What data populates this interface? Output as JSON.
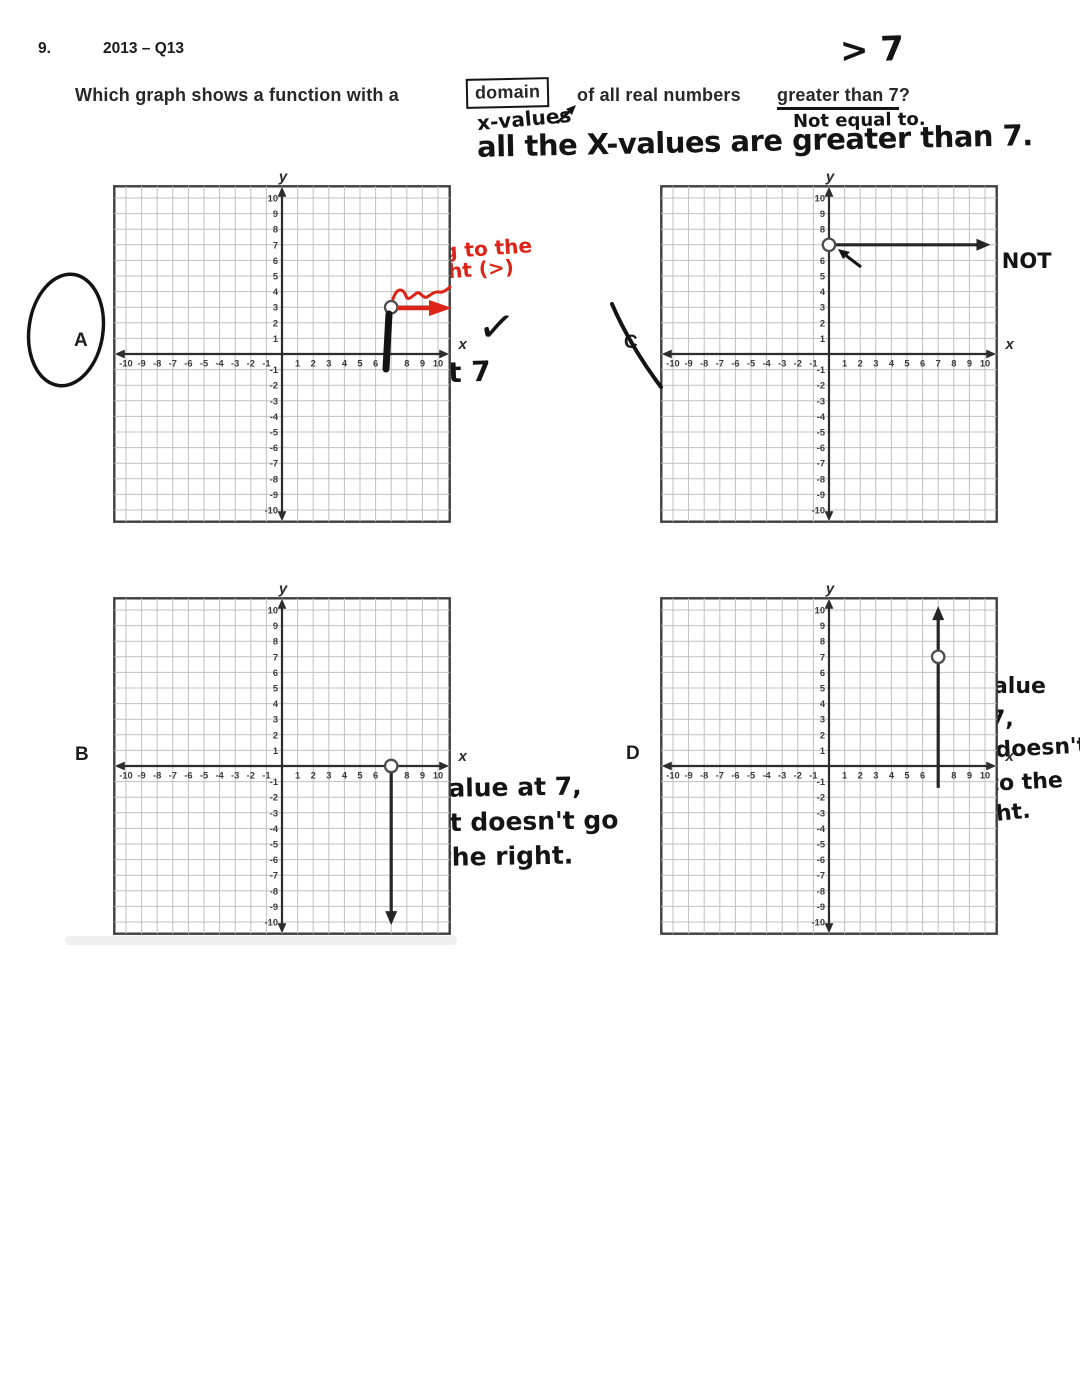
{
  "document": {
    "paper": "#ffffff",
    "ink": "#141414",
    "red": "#dd2418"
  },
  "header": {
    "number": "9.",
    "code": "2013 – Q13"
  },
  "question": {
    "part1": "Which graph shows a function with a",
    "boxed": "domain",
    "part2": "of all real numbers",
    "underlined": "greater than 7",
    "mark": "?"
  },
  "handwritten": {
    "above_question": "> 7",
    "under_box": "x-values",
    "under_underline": "Not equal to.",
    "summary": "all the X-values are greater than 7.",
    "a_red_1": "going to the",
    "a_red_2": "right (>)",
    "a_below_axis": "X is at 7",
    "a_check": "✓",
    "c_note_1": "y value @ 7, NOT",
    "c_note_2": "X value",
    "b_note_1": "y value at 7,",
    "b_note_2": "but doesn't go",
    "b_note_3": "to the right.",
    "d_note_1": "X value",
    "d_note_2": "at 7,",
    "d_note_3": "but doesn't",
    "d_note_4": "go to the",
    "d_note_5": "right."
  },
  "axis": {
    "min": -10,
    "max": 10,
    "x_title": "x",
    "y_title": "y",
    "tick_values": [
      -10,
      -9,
      -8,
      -7,
      -6,
      -5,
      -4,
      -3,
      -2,
      -1,
      1,
      2,
      3,
      4,
      5,
      6,
      7,
      8,
      9,
      10
    ]
  },
  "chart_data": [
    {
      "id": "A",
      "type": "line",
      "label": "A",
      "student_mark": "circled (chosen answer)",
      "open_point": {
        "x": 7,
        "y": 3
      },
      "ray": {
        "from": {
          "x": 7,
          "y": 3
        },
        "to": {
          "x": 10.35,
          "y": 3
        }
      },
      "hide_x_tick": 7,
      "hide_y_tick": null,
      "xlim": [
        -10,
        10
      ],
      "ylim": [
        -10,
        10
      ]
    },
    {
      "id": "C",
      "type": "line",
      "label": "C",
      "student_mark": "crossed-out",
      "open_point": {
        "x": 0,
        "y": 7
      },
      "ray": {
        "from": {
          "x": 0,
          "y": 7
        },
        "to": {
          "x": 10.35,
          "y": 7
        }
      },
      "hide_x_tick": null,
      "hide_y_tick": 7,
      "xlim": [
        -10,
        10
      ],
      "ylim": [
        -10,
        10
      ]
    },
    {
      "id": "B",
      "type": "line",
      "label": "B",
      "student_mark": null,
      "open_point": {
        "x": 7,
        "y": 0
      },
      "ray": {
        "from": {
          "x": 7,
          "y": 0
        },
        "to": {
          "x": 7,
          "y": -10.2
        }
      },
      "hide_x_tick": 7,
      "hide_y_tick": null,
      "xlim": [
        -10,
        10
      ],
      "ylim": [
        -10,
        10
      ]
    },
    {
      "id": "D",
      "type": "line",
      "label": "D",
      "student_mark": null,
      "open_point": {
        "x": 7,
        "y": 7
      },
      "ray": {
        "from": {
          "x": 7,
          "y": -1.4
        },
        "to": {
          "x": 7,
          "y": 10.25
        }
      },
      "hide_x_tick": 7,
      "hide_y_tick": null,
      "xlim": [
        -10,
        10
      ],
      "ylim": [
        -10,
        10
      ]
    }
  ]
}
